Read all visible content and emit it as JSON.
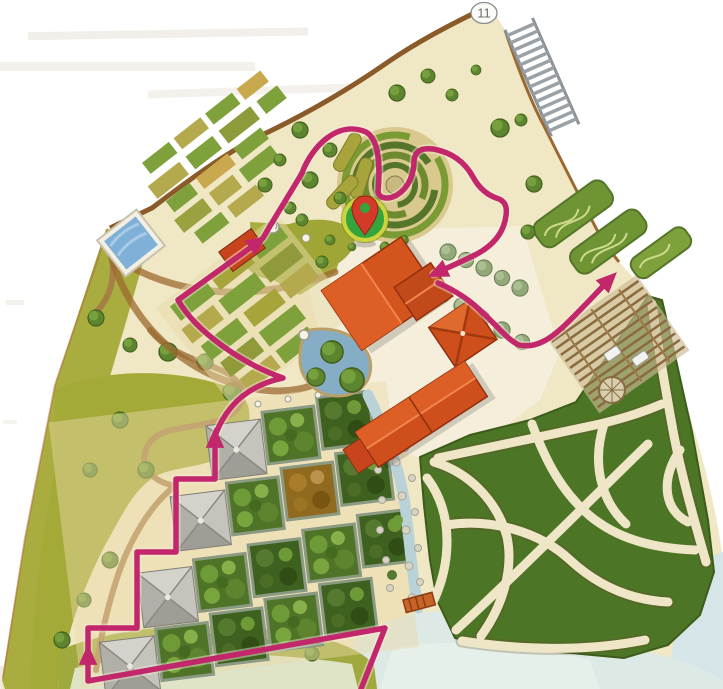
{
  "map": {
    "badge": {
      "label": "11"
    },
    "marker": {
      "icon": "location-pin-icon"
    },
    "colors": {
      "route": "#c2276b",
      "pin_ring": "#cdd43b",
      "pin_fill": "#36a43c",
      "pin_glyph": "#d23b2a",
      "roof_orange": "#d0511d",
      "map_cream": "#f0e7c5",
      "meadow_olive": "#a9ad3f",
      "maze_green": "#4d7526",
      "water": "#b9d2d8",
      "pyramid_gray": "#b9b9b1",
      "wall_brown": "#8a5a28"
    }
  }
}
